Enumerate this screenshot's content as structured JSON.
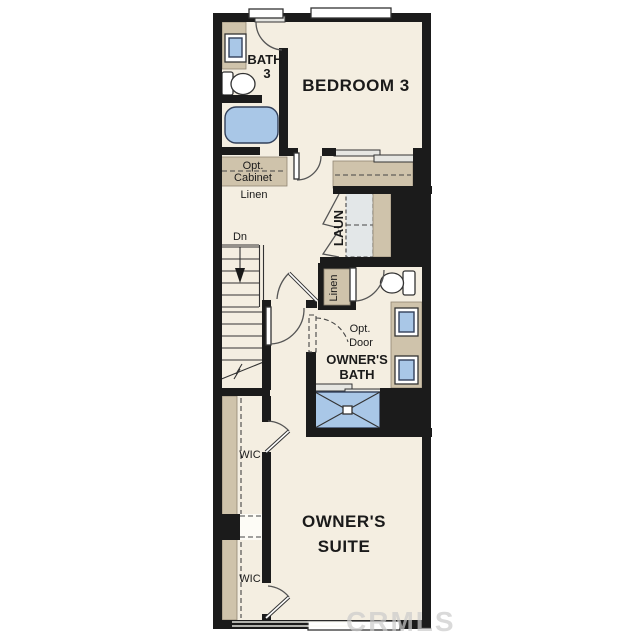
{
  "plan": {
    "rooms": {
      "bath3": {
        "line1": "BATH",
        "line2": "3"
      },
      "bedroom3": {
        "label": "BEDROOM 3"
      },
      "opt_cabinet": {
        "line1": "Opt.",
        "line2": "Cabinet"
      },
      "linen_hall": {
        "label": "Linen"
      },
      "stairs": {
        "label": "Dn"
      },
      "laundry": {
        "label": "LAUN"
      },
      "linen_closet": {
        "label": "Linen"
      },
      "opt_door": {
        "line1": "Opt.",
        "line2": "Door"
      },
      "owners_bath": {
        "line1": "OWNER'S",
        "line2": "BATH"
      },
      "wic_upper": {
        "label": "WIC"
      },
      "wic_lower": {
        "label": "WIC"
      },
      "owners_suite": {
        "line1": "OWNER'S",
        "line2": "SUITE"
      }
    },
    "watermark": {
      "label": "CRMLS"
    },
    "colors": {
      "wall": "#1b1b1b",
      "floor": "#f4eee1",
      "cabinet_tan": "#cfc3ab",
      "fixture_blue": "#a9c7e7",
      "appliance_gray": "#e3e7e8",
      "background": "#ffffff"
    }
  }
}
